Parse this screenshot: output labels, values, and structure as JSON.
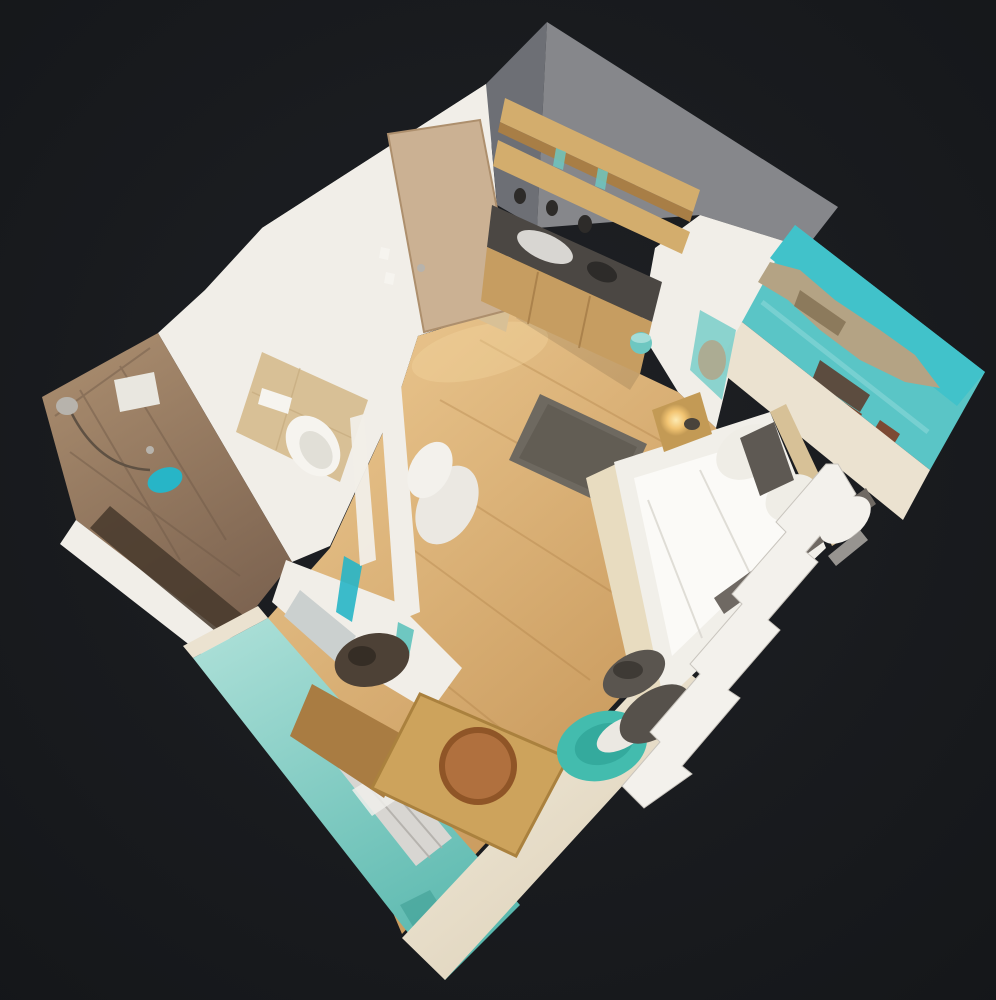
{
  "meta": {
    "description": "3D dollhouse top-down view of a small studio apartment (photogrammetry scan) floating on a dark charcoal background, rotated diamond orientation",
    "view_type": "dollhouse-3d",
    "canvas": {
      "width": 996,
      "height": 1000
    }
  },
  "scene": {
    "rooms": [
      "kitchen-corner",
      "entrance-hall",
      "bathroom",
      "sleeping-living-area",
      "dining-corner"
    ],
    "objects": [
      "entrance-door",
      "kitchen-wall-shelves",
      "kitchen-counter-with-sink",
      "kitchen-base-cabinet",
      "teal-pedal-bin",
      "beach-mural-wall",
      "double-bed",
      "white-pillows",
      "dark-pillow",
      "grey-blanket",
      "nightstand-with-lit-lamp",
      "shaggy-grey-rug",
      "wall-hung-toilet",
      "tiled-shower-wall",
      "shower-head",
      "teal-washcloth",
      "mirror-vanity",
      "wardrobe-with-dark-clothes",
      "teal-accent-wall-with-radiator",
      "wooden-dining-table",
      "round-terracotta-tray",
      "teal-chair",
      "grey-bag-on-floor",
      "white-sheer-curtain"
    ]
  },
  "colors": {
    "bg": "#1f2125",
    "bg_edge": "#141619",
    "wall_white": "#f1eee8",
    "wall_shadow": "#d7d3cb",
    "wall_cream": "#ebe2d0",
    "wall_grey": "#86878b",
    "wall_grey_dark": "#6d6f75",
    "door_wood": "#cbb193",
    "door_edge": "#ad8f6d",
    "tile_beige": "#d8c096",
    "tile_line": "#bfa376",
    "floor_light": "#e7c28a",
    "floor_mid": "#c39254",
    "floor_plank": "#a87940",
    "shelf_tan": "#d3ad6d",
    "shelf_shadow": "#a87e46",
    "counter_dark": "#4b4743",
    "counter_black": "#2d2b29",
    "sink_white": "#d8d6d2",
    "cabinet_wood": "#c69d61",
    "cabinet_line": "#a07844",
    "bin_teal": "#6ec7c1",
    "bin_teal_light": "#a4ddd8",
    "mural_sky": "#41c2ca",
    "mural_sea": "#5ac5c6",
    "mural_sea_light": "#8fd9da",
    "mural_rock": "#b4a384",
    "mural_rock_dark": "#8c7a5c",
    "mural_brown": "#7c4a33",
    "mural_dark": "#5c4c3f",
    "mural_inner": "#7fcfcb",
    "bed_white": "#f1efe9",
    "duvet_bright": "#fbfaf7",
    "duvet_fold": "#d9d6cf",
    "bed_frame": "#e8dcc0",
    "headboard": "#d7c197",
    "pillow_white": "#efede6",
    "pillow_dark": "#5e5953",
    "blanket_grey": "#6f6963",
    "foot_pillow": "#56514b",
    "fluff_white": "#ebe8e2",
    "curtain_white": "#f3f1ec",
    "curtain_shadow": "#c9c5be",
    "nightstand_wood": "#c39a55",
    "lamp_glow": "#f2c472",
    "lamp_core": "#fdeab2",
    "item_dark": "#49433b",
    "rug_grey": "#6e6960",
    "rug_dark": "#5a554d",
    "shower_tile_light": "#a98c6e",
    "shower_tile_dark": "#7c6350",
    "grout_line": "#6f5947",
    "bath_floor_dark": "#46382b",
    "washcloth_teal": "#27b5c7",
    "window_white": "#e9e7e0",
    "metal_grey": "#b7b3ac",
    "hose_dark": "#5f5143",
    "porcelain": "#f6f4ef",
    "porcelain_shadow": "#d9d5cd",
    "mirror_grey": "#cbd0cf",
    "fur_dark": "#4d4136",
    "fur_core": "#352d25",
    "teal_light": "#a9ded6",
    "teal_deep": "#57b7ad",
    "teal_shade": "#3f9e94",
    "radiator_silver": "#d8d6d2",
    "radiator_line": "#aeaba6",
    "radiator_patch": "#f0efeb",
    "cream_light": "#f3edde",
    "cream_deep": "#dccfb6",
    "desk_wood": "#a97c42",
    "table_wood": "#cda35c",
    "table_edge": "#aa813e",
    "plate_terracotta": "#b0703e",
    "plate_rim": "#8f5527",
    "chair_teal": "#43bcae",
    "chair_teal_dark": "#2da093",
    "bag_grey": "#5a554f",
    "bag_core": "#3e3a35",
    "shadow_black": "#000000",
    "highlight_warm": "#f3d49e"
  }
}
